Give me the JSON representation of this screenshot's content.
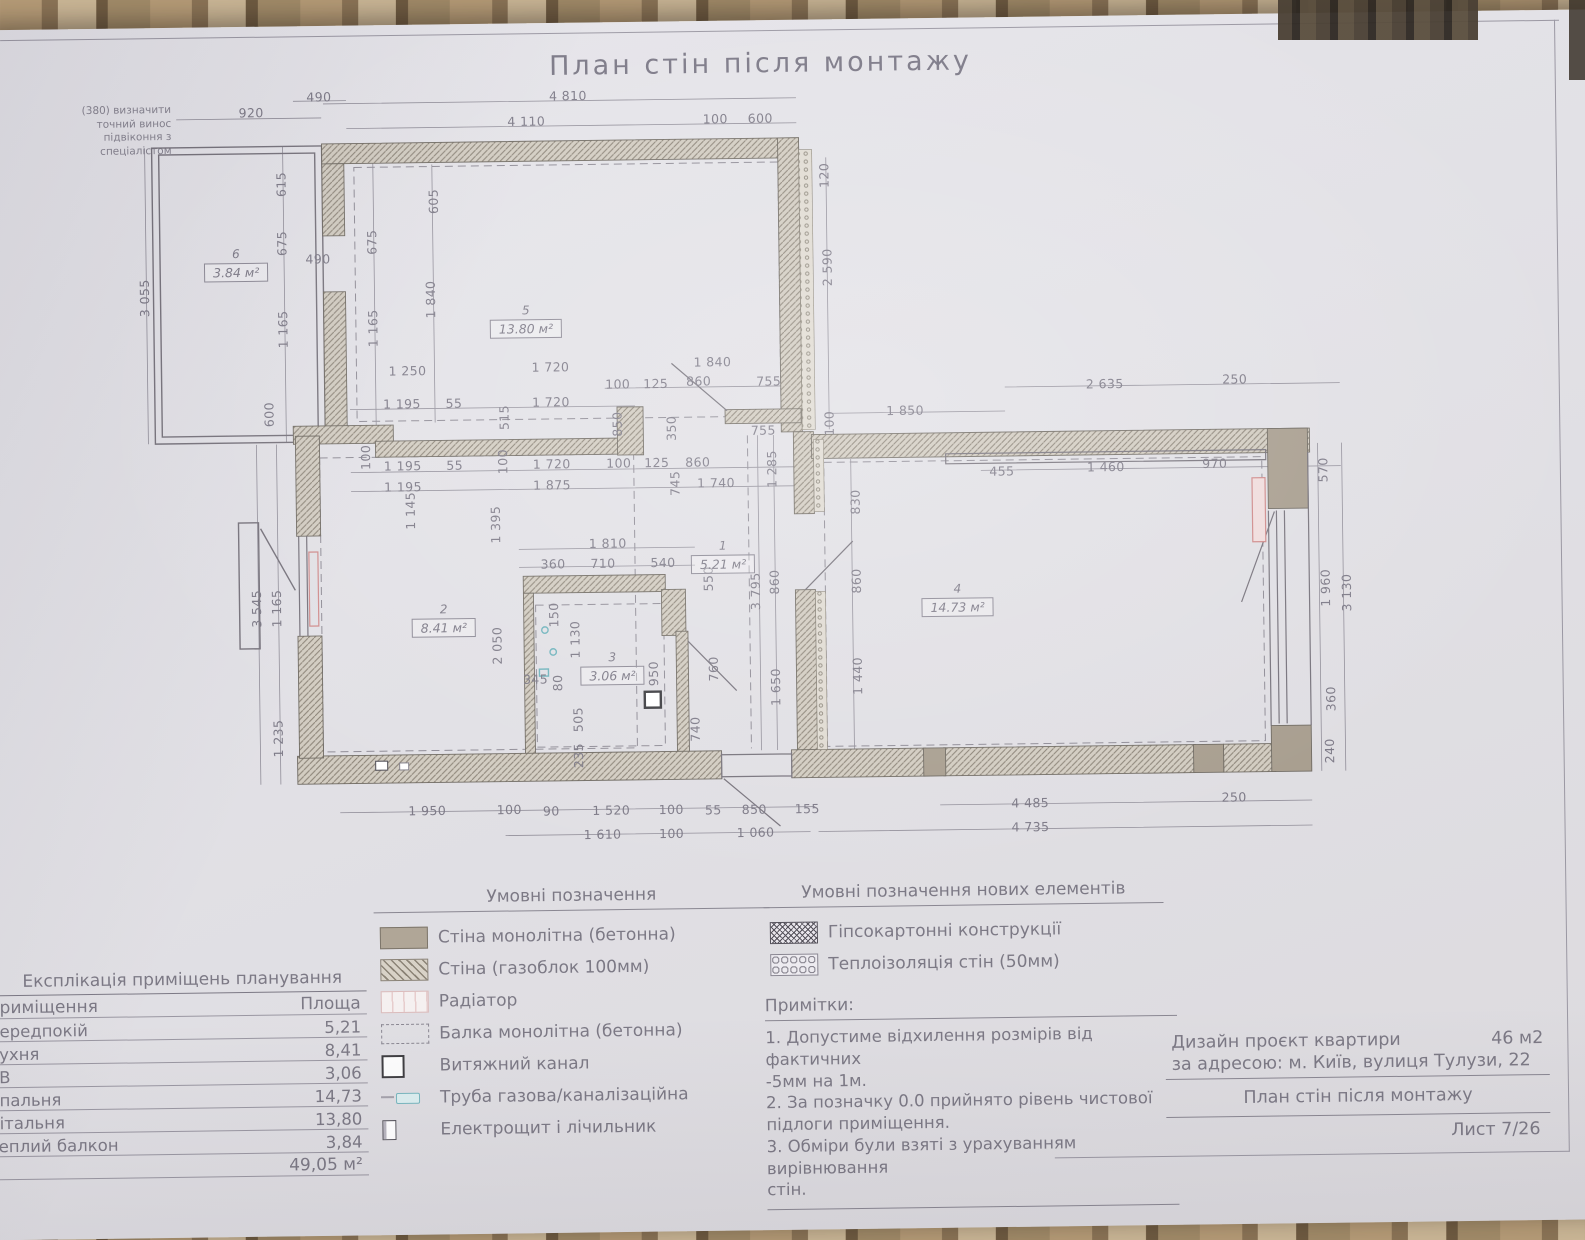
{
  "title": "План стін після монтажу",
  "corner_note": "(380) визначити\nточний винос\nпідвіконня з\nспеціалістом",
  "colors": {
    "paper": "#e2e1e6",
    "line": "#8b8894",
    "text": "#7c7985",
    "wall_hatch": "#cdc6ba",
    "wall_line": "#7e7870",
    "concrete": "#a89e8f",
    "radiator_accent": "#d98f8f",
    "pipe_accent": "#79b7bf",
    "curtain": "#8a7356"
  },
  "plan": {
    "rooms": [
      {
        "n": "1",
        "a": "5.21 м²",
        "x": 716,
        "y": 548
      },
      {
        "n": "2",
        "a": "8.41 м²",
        "x": 436,
        "y": 608
      },
      {
        "n": "3",
        "a": "3.06 м²",
        "x": 604,
        "y": 658
      },
      {
        "n": "4",
        "a": "14.73 м²",
        "x": 950,
        "y": 594
      },
      {
        "n": "5",
        "a": "13.80 м²",
        "x": 522,
        "y": 310
      },
      {
        "n": "6",
        "a": "3.84 м²",
        "x": 233,
        "y": 250
      }
    ],
    "dimensions": [
      {
        "t": "920",
        "x": 250,
        "y": 116
      },
      {
        "t": "490",
        "x": 318,
        "y": 101
      },
      {
        "t": "4 810",
        "x": 567,
        "y": 103
      },
      {
        "t": "4 110",
        "x": 525,
        "y": 128
      },
      {
        "t": "100",
        "x": 714,
        "y": 128
      },
      {
        "t": "600",
        "x": 759,
        "y": 128
      },
      {
        "t": "120",
        "x": 822,
        "y": 186,
        "v": 1
      },
      {
        "t": "2 590",
        "x": 824,
        "y": 278,
        "v": 1
      },
      {
        "t": "3 055",
        "x": 141,
        "y": 300,
        "v": 1
      },
      {
        "t": "615",
        "x": 279,
        "y": 188,
        "v": 1
      },
      {
        "t": "675",
        "x": 279,
        "y": 247,
        "v": 1
      },
      {
        "t": "490",
        "x": 315,
        "y": 263
      },
      {
        "t": "675",
        "x": 369,
        "y": 247,
        "v": 1
      },
      {
        "t": "605",
        "x": 431,
        "y": 207,
        "v": 1
      },
      {
        "t": "1 840",
        "x": 427,
        "y": 305,
        "v": 1
      },
      {
        "t": "1 165",
        "x": 279,
        "y": 333,
        "v": 1
      },
      {
        "t": "1 165",
        "x": 369,
        "y": 333,
        "v": 1
      },
      {
        "t": "600",
        "x": 264,
        "y": 418,
        "v": 1
      },
      {
        "t": "1 250",
        "x": 403,
        "y": 376
      },
      {
        "t": "1 720",
        "x": 546,
        "y": 374
      },
      {
        "t": "1 840",
        "x": 708,
        "y": 371
      },
      {
        "t": "100",
        "x": 613,
        "y": 392
      },
      {
        "t": "125",
        "x": 651,
        "y": 392
      },
      {
        "t": "860",
        "x": 694,
        "y": 390
      },
      {
        "t": "755",
        "x": 764,
        "y": 391
      },
      {
        "t": "1 195",
        "x": 397,
        "y": 409
      },
      {
        "t": "55",
        "x": 449,
        "y": 409
      },
      {
        "t": "1 720",
        "x": 546,
        "y": 409
      },
      {
        "t": "515",
        "x": 499,
        "y": 424,
        "v": 1
      },
      {
        "t": "100",
        "x": 360,
        "y": 462,
        "v": 1
      },
      {
        "t": "100",
        "x": 497,
        "y": 468,
        "v": 1
      },
      {
        "t": "850",
        "x": 612,
        "y": 432,
        "v": 1
      },
      {
        "t": "350",
        "x": 666,
        "y": 437,
        "v": 1
      },
      {
        "t": "755",
        "x": 758,
        "y": 440
      },
      {
        "t": "100",
        "x": 824,
        "y": 434,
        "v": 1
      },
      {
        "t": "1 195",
        "x": 397,
        "y": 471
      },
      {
        "t": "55",
        "x": 449,
        "y": 471
      },
      {
        "t": "1 720",
        "x": 546,
        "y": 471
      },
      {
        "t": "100",
        "x": 613,
        "y": 471
      },
      {
        "t": "125",
        "x": 651,
        "y": 471
      },
      {
        "t": "860",
        "x": 692,
        "y": 471
      },
      {
        "t": "1 285",
        "x": 766,
        "y": 479,
        "v": 1
      },
      {
        "t": "1 195",
        "x": 397,
        "y": 492
      },
      {
        "t": "1 875",
        "x": 546,
        "y": 492
      },
      {
        "t": "745",
        "x": 669,
        "y": 492,
        "v": 1
      },
      {
        "t": "1 740",
        "x": 710,
        "y": 492
      },
      {
        "t": "1 145",
        "x": 404,
        "y": 516,
        "v": 1
      },
      {
        "t": "1 395",
        "x": 489,
        "y": 531,
        "v": 1
      },
      {
        "t": "2 050",
        "x": 489,
        "y": 652,
        "v": 1
      },
      {
        "t": "3 545",
        "x": 249,
        "y": 612,
        "v": 1
      },
      {
        "t": "1 165",
        "x": 269,
        "y": 612,
        "v": 1
      },
      {
        "t": "1 235",
        "x": 269,
        "y": 742,
        "v": 1
      },
      {
        "t": "1 850",
        "x": 900,
        "y": 422
      },
      {
        "t": "2 635",
        "x": 1100,
        "y": 398
      },
      {
        "t": "250",
        "x": 1230,
        "y": 395
      },
      {
        "t": "455",
        "x": 996,
        "y": 484
      },
      {
        "t": "1 460",
        "x": 1100,
        "y": 481
      },
      {
        "t": "970",
        "x": 1209,
        "y": 479
      },
      {
        "t": "570",
        "x": 1317,
        "y": 487,
        "v": 1
      },
      {
        "t": "1 960",
        "x": 1318,
        "y": 605,
        "v": 1
      },
      {
        "t": "3 130",
        "x": 1339,
        "y": 610,
        "v": 1
      },
      {
        "t": "360",
        "x": 1322,
        "y": 716,
        "v": 1
      },
      {
        "t": "240",
        "x": 1320,
        "y": 768,
        "v": 1
      },
      {
        "t": "1 810",
        "x": 601,
        "y": 551
      },
      {
        "t": "360",
        "x": 546,
        "y": 571
      },
      {
        "t": "710",
        "x": 596,
        "y": 571
      },
      {
        "t": "540",
        "x": 656,
        "y": 571
      },
      {
        "t": "550",
        "x": 701,
        "y": 588,
        "v": 1
      },
      {
        "t": "3 795",
        "x": 748,
        "y": 601,
        "v": 1
      },
      {
        "t": "860",
        "x": 767,
        "y": 592,
        "v": 1
      },
      {
        "t": "830",
        "x": 849,
        "y": 513,
        "v": 1
      },
      {
        "t": "860",
        "x": 849,
        "y": 592,
        "v": 1
      },
      {
        "t": "1 440",
        "x": 849,
        "y": 687,
        "v": 1
      },
      {
        "t": "1 650",
        "x": 767,
        "y": 697,
        "v": 1
      },
      {
        "t": "150",
        "x": 546,
        "y": 622,
        "v": 1
      },
      {
        "t": "1 130",
        "x": 567,
        "y": 647,
        "v": 1
      },
      {
        "t": "345",
        "x": 527,
        "y": 686
      },
      {
        "t": "80",
        "x": 549,
        "y": 690,
        "v": 1
      },
      {
        "t": "950",
        "x": 645,
        "y": 682,
        "v": 1
      },
      {
        "t": "760",
        "x": 705,
        "y": 678,
        "v": 1
      },
      {
        "t": "505",
        "x": 569,
        "y": 727,
        "v": 1
      },
      {
        "t": "235",
        "x": 569,
        "y": 763,
        "v": 1
      },
      {
        "t": "740",
        "x": 686,
        "y": 738,
        "v": 1
      },
      {
        "t": "1 950",
        "x": 417,
        "y": 816
      },
      {
        "t": "100",
        "x": 499,
        "y": 816
      },
      {
        "t": "90",
        "x": 541,
        "y": 818
      },
      {
        "t": "1 520",
        "x": 601,
        "y": 818
      },
      {
        "t": "100",
        "x": 661,
        "y": 818
      },
      {
        "t": "55",
        "x": 703,
        "y": 819
      },
      {
        "t": "850",
        "x": 744,
        "y": 819
      },
      {
        "t": "155",
        "x": 797,
        "y": 819
      },
      {
        "t": "4 485",
        "x": 1020,
        "y": 816
      },
      {
        "t": "250",
        "x": 1224,
        "y": 813
      },
      {
        "t": "1 610",
        "x": 592,
        "y": 842
      },
      {
        "t": "100",
        "x": 661,
        "y": 842
      },
      {
        "t": "1 060",
        "x": 745,
        "y": 842
      },
      {
        "t": "4 735",
        "x": 1020,
        "y": 840
      }
    ]
  },
  "legend": {
    "title": "Умовні позначення",
    "items": [
      {
        "type": "solid",
        "label": "Стіна монолітна (бетонна)"
      },
      {
        "type": "hatch",
        "label": "Стіна (газоблок 100мм)"
      },
      {
        "type": "radiator",
        "label": "Радіатор"
      },
      {
        "type": "dashed",
        "label": "Балка монолітна (бетонна)"
      },
      {
        "type": "vent",
        "label": "Витяжний канал"
      },
      {
        "type": "pipe",
        "label": "Труба газова/каналізаційна"
      },
      {
        "type": "panel",
        "label": "Електрощит і лічильник"
      }
    ]
  },
  "legend_new": {
    "title": "Умовні позначення нових елементів",
    "items": [
      {
        "type": "crosshatch",
        "label": "Гіпсокартонні конструкції"
      },
      {
        "type": "insulation",
        "label": "Теплоізоляція стін (50мм)"
      }
    ]
  },
  "notes": {
    "title": "Примітки:",
    "lines": [
      "1. Допустиме відхилення розмірів від фактичних",
      "-5мм на 1м.",
      "2. За позначку 0.0 прийнято рівень чистової",
      "підлоги приміщення.",
      "3. Обміри були взяті з урахуванням вирівнювання",
      "стін."
    ]
  },
  "table": {
    "title": "Експлікація приміщень планування",
    "col_room": "Приміщення",
    "col_area": "Площа",
    "rows": [
      {
        "name": "Передпокій",
        "area": "5,21"
      },
      {
        "name": "Кухня",
        "area": "8,41"
      },
      {
        "name": "СВ",
        "area": "3,06"
      },
      {
        "name": "Спальня",
        "area": "14,73"
      },
      {
        "name": "Вітальня",
        "area": "13,80"
      },
      {
        "name": "Теплий балкон",
        "area": "3,84"
      }
    ],
    "total": "49,05 м²"
  },
  "titleblock": {
    "project": "Дизайн проєкт квартири",
    "area": "46 м2",
    "address": "за адресою: м. Київ, вулиця Тулузи, 22",
    "drawing": "План стін після монтажу",
    "sheet": "Лист 7/26"
  }
}
